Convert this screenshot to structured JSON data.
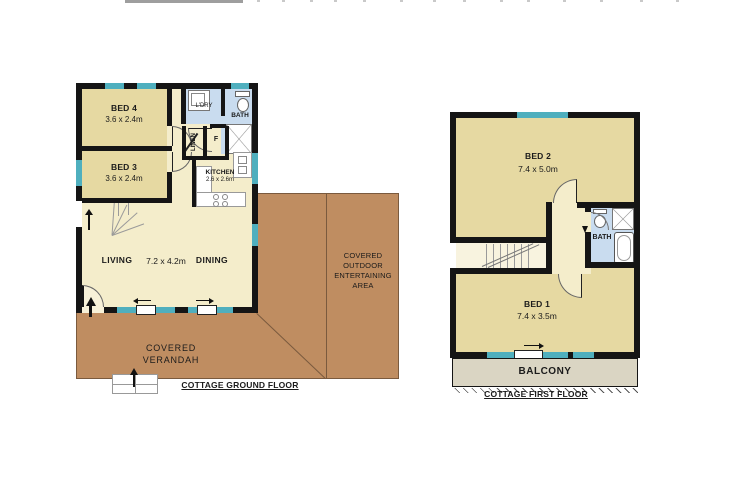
{
  "colors": {
    "wall": "#151515",
    "window": "#4FAFBE",
    "cream": "#F4EDCB",
    "tan": "#E6D9A2",
    "blue": "#C9DCEF",
    "brown": "#BF8D61",
    "balcony": "#DAD5C3"
  },
  "ground_floor": {
    "title": "COTTAGE GROUND FLOOR",
    "bed4": {
      "name": "BED 4",
      "dims": "3.6 x 2.4m"
    },
    "bed3": {
      "name": "BED 3",
      "dims": "3.6 x 2.4m"
    },
    "laundry": "L'DRY",
    "bath": "BATH",
    "linen": "LINEN",
    "fridge": "F",
    "kitchen": {
      "name": "KITCHEN",
      "dims": "2.6 x 2.6m"
    },
    "living": "LIVING",
    "dining": "DINING",
    "living_dining_dims": "7.2 x 4.2m",
    "verandah": {
      "line1": "COVERED",
      "line2": "VERANDAH"
    },
    "outdoor": {
      "line1": "COVERED",
      "line2": "OUTDOOR",
      "line3": "ENTERTAINING",
      "line4": "AREA"
    }
  },
  "first_floor": {
    "title": "COTTAGE FIRST FLOOR",
    "bed2": {
      "name": "BED 2",
      "dims": "7.4 x 5.0m"
    },
    "bed1": {
      "name": "BED 1",
      "dims": "7.4 x 3.5m"
    },
    "bath": "BATH",
    "balcony": "BALCONY"
  },
  "icons": {
    "entry-arrow": "▲",
    "slide-arrow-left": "◄",
    "slide-arrow-right": "►",
    "shower-icon": "✕",
    "up-arrow-stairs": "▲"
  }
}
